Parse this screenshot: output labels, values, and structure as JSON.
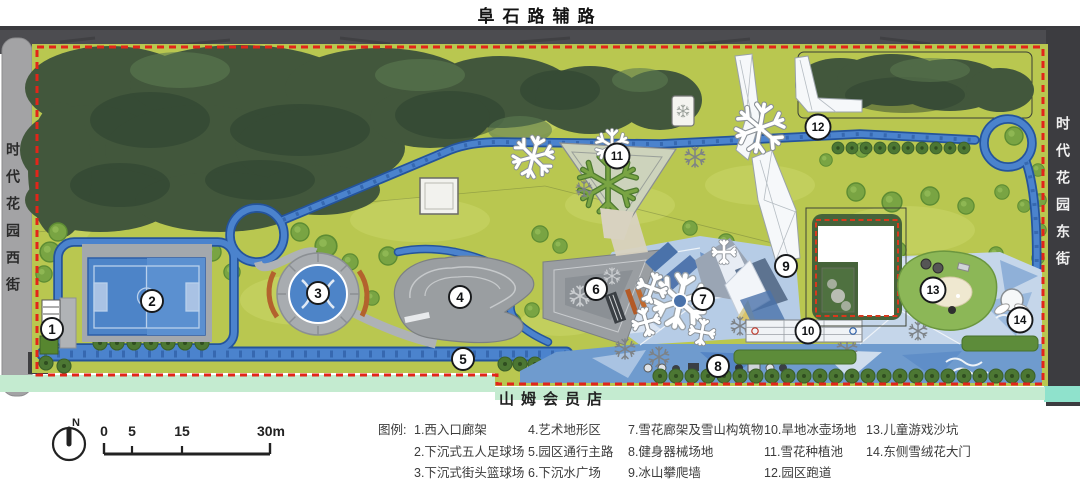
{
  "roads": {
    "top": "阜石路辅路",
    "west": "时代花园西街",
    "east": "时代花园东街",
    "store_bottom": "山姆会员店"
  },
  "legend": {
    "title": "图例:",
    "columns": [
      [
        "1.西入口廊架",
        "2.下沉式五人足球场",
        "3.下沉式街头篮球场"
      ],
      [
        "4.艺术地形区",
        "5.园区通行主路",
        "6.下沉水广场"
      ],
      [
        "7.雪花廊架及雪山构筑物",
        "8.健身器械场地",
        "9.冰山攀爬墙"
      ],
      [
        "10.旱地冰壶场地",
        "11.雪花种植池",
        "12.园区跑道"
      ],
      [
        "13.儿童游戏沙坑",
        "14.东侧雪绒花大门"
      ]
    ]
  },
  "scalebar": {
    "north": "N",
    "t0": "0",
    "t1": "5",
    "t2": "15",
    "t3": "30m"
  },
  "plan": {
    "markers": [
      {
        "n": "1",
        "x": 52,
        "y": 329
      },
      {
        "n": "2",
        "x": 152,
        "y": 301
      },
      {
        "n": "3",
        "x": 318,
        "y": 293
      },
      {
        "n": "4",
        "x": 460,
        "y": 297
      },
      {
        "n": "5",
        "x": 463,
        "y": 359
      },
      {
        "n": "6",
        "x": 596,
        "y": 289
      },
      {
        "n": "7",
        "x": 703,
        "y": 299
      },
      {
        "n": "8",
        "x": 718,
        "y": 366
      },
      {
        "n": "9",
        "x": 786,
        "y": 266
      },
      {
        "n": "10",
        "x": 808,
        "y": 331
      },
      {
        "n": "11",
        "x": 617,
        "y": 156
      },
      {
        "n": "12",
        "x": 818,
        "y": 127
      },
      {
        "n": "13",
        "x": 933,
        "y": 290
      },
      {
        "n": "14",
        "x": 1020,
        "y": 320
      }
    ]
  },
  "colors": {
    "boundary_red": "#e2251a",
    "track_blue": "#4b83cd",
    "field_blue": "#4d84c8",
    "lawn_green": "#b9c750",
    "forest_green": "#42573c",
    "ice_blue": "#b6cce6",
    "road_dark": "#47474b",
    "road_light": "#a3a3a5",
    "strip_green": "#c4ebd0",
    "strip_teal": "#8fe2cc"
  }
}
